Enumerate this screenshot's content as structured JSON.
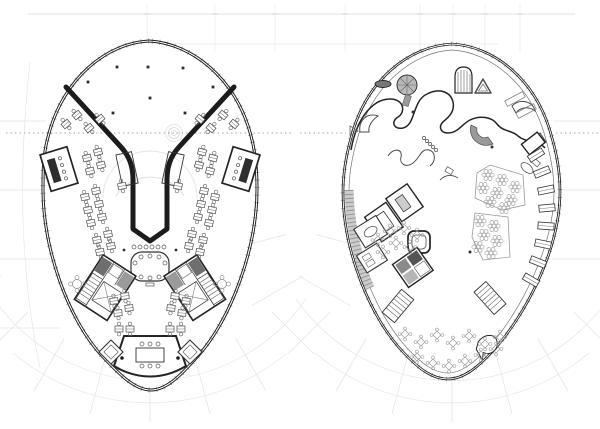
{
  "canvas": {
    "width": 600,
    "height": 429,
    "background": "#ffffff"
  },
  "palette": {
    "ink": "#1c1c1c",
    "wall": "#242424",
    "medium": "#4a4a4a",
    "thin": "#6b6b6b",
    "light": "#9a9a9a",
    "fill_dark": "#6e6e6e",
    "fill_gray": "#b9b9b9",
    "faint": "#e2e2e8",
    "fainter": "#ececf1",
    "dashed": "#8a8a8a"
  },
  "grid": {
    "fan_centers": [
      150,
      452
    ],
    "fan_center_y": 190,
    "fan_inner_radius": 172,
    "fan_outer_radius": 232,
    "fan_angle_start": 15,
    "fan_angle_end": 165,
    "fan_angle_step": 15,
    "top_vertical_xs": [
      147,
      215,
      275,
      345,
      420,
      453,
      485,
      520
    ]
  },
  "left_plan": {
    "column_dots": [
      [
        117,
        67
      ],
      [
        148,
        67
      ],
      [
        183,
        68
      ],
      [
        88,
        82
      ],
      [
        213,
        87
      ],
      [
        150,
        98
      ],
      [
        113,
        113
      ],
      [
        185,
        113
      ]
    ],
    "desks": [
      [
        66,
        124,
        -40
      ],
      [
        77,
        115,
        -40
      ],
      [
        89,
        128,
        -40
      ],
      [
        100,
        119,
        -40
      ],
      [
        234,
        124,
        40
      ],
      [
        223,
        115,
        40
      ],
      [
        211,
        128,
        40
      ],
      [
        200,
        119,
        40
      ],
      [
        87,
        158,
        -15
      ],
      [
        98,
        152,
        -15
      ],
      [
        90,
        171,
        -15
      ],
      [
        101,
        165,
        -15
      ],
      [
        85,
        197,
        -12
      ],
      [
        96,
        191,
        -12
      ],
      [
        88,
        210,
        -12
      ],
      [
        99,
        204,
        -12
      ],
      [
        91,
        223,
        -12
      ],
      [
        102,
        217,
        -12
      ],
      [
        97,
        240,
        -10
      ],
      [
        108,
        234,
        -10
      ],
      [
        100,
        252,
        -10
      ],
      [
        111,
        246,
        -10
      ],
      [
        114,
        301,
        -6
      ],
      [
        125,
        296,
        -6
      ],
      [
        118,
        313,
        -6
      ],
      [
        129,
        308,
        -6
      ],
      [
        213,
        158,
        15
      ],
      [
        202,
        152,
        15
      ],
      [
        210,
        171,
        15
      ],
      [
        199,
        165,
        15
      ],
      [
        215,
        197,
        12
      ],
      [
        204,
        191,
        12
      ],
      [
        212,
        210,
        12
      ],
      [
        201,
        204,
        12
      ],
      [
        209,
        223,
        12
      ],
      [
        198,
        217,
        12
      ],
      [
        203,
        240,
        10
      ],
      [
        192,
        234,
        10
      ],
      [
        200,
        252,
        10
      ],
      [
        189,
        246,
        10
      ],
      [
        186,
        301,
        6
      ],
      [
        175,
        296,
        6
      ],
      [
        182,
        313,
        6
      ],
      [
        171,
        308,
        6
      ],
      [
        119,
        329,
        0
      ],
      [
        130,
        329,
        0
      ],
      [
        170,
        329,
        0
      ],
      [
        181,
        329,
        0
      ],
      [
        122,
        186,
        -12
      ],
      [
        178,
        186,
        12
      ]
    ],
    "flower_tables": [
      [
        77,
        284
      ],
      [
        222,
        284
      ]
    ],
    "boardroom_chairs": [
      [
        141,
        257
      ],
      [
        150,
        256
      ],
      [
        159,
        257
      ],
      [
        141,
        277
      ],
      [
        150,
        278
      ],
      [
        159,
        277
      ],
      [
        135,
        263
      ],
      [
        165,
        263
      ]
    ],
    "notch_scallops_y": 247,
    "notch_scallops_xs": [
      134,
      140,
      146,
      152,
      158,
      164
    ]
  },
  "right_plan": {
    "column_dots": [
      [
        413,
        112
      ],
      [
        492,
        147
      ],
      [
        470,
        252
      ]
    ],
    "cafe_tables": [
      [
        405,
        334
      ],
      [
        421,
        342
      ],
      [
        437,
        335
      ],
      [
        453,
        343
      ],
      [
        469,
        336
      ],
      [
        485,
        344
      ],
      [
        500,
        337
      ],
      [
        417,
        357
      ],
      [
        433,
        363
      ],
      [
        449,
        366
      ],
      [
        465,
        361
      ],
      [
        481,
        355
      ],
      [
        496,
        349
      ],
      [
        390,
        231
      ],
      [
        404,
        228
      ],
      [
        417,
        235
      ],
      [
        396,
        243
      ],
      [
        410,
        247
      ],
      [
        378,
        240
      ],
      [
        383,
        252
      ]
    ],
    "hex_tables": [
      [
        488,
        175
      ],
      [
        502,
        180
      ],
      [
        515,
        187
      ],
      [
        483,
        188
      ],
      [
        497,
        193
      ],
      [
        511,
        200
      ],
      [
        490,
        202
      ],
      [
        504,
        208
      ],
      [
        480,
        221
      ],
      [
        494,
        226
      ],
      [
        484,
        235
      ],
      [
        497,
        241
      ],
      [
        478,
        247
      ],
      [
        491,
        253
      ]
    ],
    "bead_seats": [
      [
        424,
        138
      ],
      [
        427,
        141
      ],
      [
        430,
        144
      ],
      [
        433,
        147
      ],
      [
        436,
        150
      ]
    ],
    "kitchen_counters": [
      [
        536,
        155,
        -32
      ],
      [
        542,
        172,
        -22
      ],
      [
        546,
        190,
        -12
      ],
      [
        547,
        208,
        -5
      ],
      [
        546,
        226,
        4
      ],
      [
        543,
        244,
        12
      ],
      [
        538,
        262,
        22
      ],
      [
        531,
        280,
        30
      ]
    ]
  }
}
